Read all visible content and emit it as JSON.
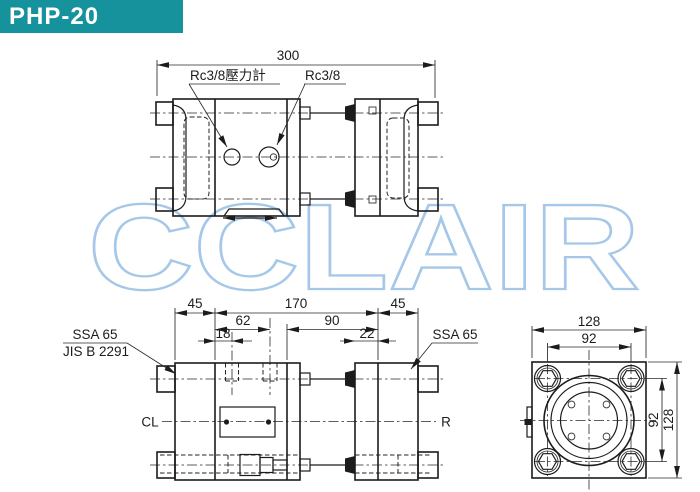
{
  "header": {
    "model": "PHP-20"
  },
  "watermark": {
    "text": "CCLAIR",
    "color": "#a6c8e8"
  },
  "colors": {
    "header_bg": "#16929c",
    "header_text": "#ffffff",
    "line": "#1c1c1c",
    "watermark": "#a6c8e8"
  },
  "top_view": {
    "dim_length": "300",
    "label_pressure_gauge_port": "Rc3/8壓力計",
    "label_port": "Rc3/8"
  },
  "side_view": {
    "dim_flange_left": "45",
    "dim_body_length": "170",
    "dim_flange_right": "45",
    "dim_port2_offset": "62",
    "dim_rear_length": "90",
    "dim_port1_offset": "18",
    "dim_rear_flange_offset": "22",
    "label_flange_std_line1": "SSA 65",
    "label_flange_std_line2": "JIS B 2291",
    "label_flange_right": "SSA 65",
    "label_center_left": "CL",
    "label_center_right": "R"
  },
  "end_view": {
    "dim_width_overall": "128",
    "dim_bolt_spacing_h": "92",
    "dim_bolt_spacing_v": "92",
    "dim_height_overall": "128"
  }
}
